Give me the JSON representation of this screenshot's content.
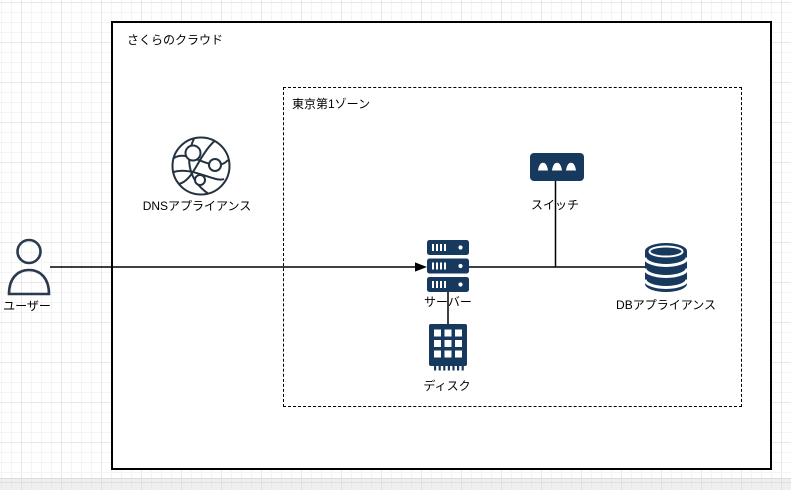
{
  "diagram": {
    "cloud_container": {
      "label": "さくらのクラウド"
    },
    "zone_container": {
      "label": "東京第1ゾーン"
    },
    "nodes": {
      "user": {
        "label": "ユーザー",
        "icon": "person-outline-icon"
      },
      "dns": {
        "label": "DNSアプライアンス",
        "icon": "network-globe-icon"
      },
      "switch": {
        "label": "スイッチ",
        "icon": "network-switch-icon"
      },
      "server": {
        "label": "サーバー",
        "icon": "server-stack-icon"
      },
      "disk": {
        "label": "ディスク",
        "icon": "disk-chip-icon"
      },
      "db": {
        "label": "DBアプライアンス",
        "icon": "database-cylinder-icon"
      }
    },
    "edges": [
      {
        "from": "user",
        "to": "server",
        "arrow": "end"
      },
      {
        "from": "server",
        "to": "db",
        "arrow": "none"
      },
      {
        "from": "switch",
        "to": "server-db-line",
        "arrow": "none"
      },
      {
        "from": "server",
        "to": "disk",
        "arrow": "none"
      }
    ],
    "colors": {
      "icon_fill": "#17395e",
      "person_outline": "#2b3a4d",
      "globe_outline": "#233140",
      "edge_line": "#000000",
      "container_border": "#000000",
      "canvas_bg": "#ffffff",
      "grid_minor": "#f4f4f4",
      "grid_major": "#e8e8e8",
      "offpage_strip": "#ebebeb"
    }
  }
}
